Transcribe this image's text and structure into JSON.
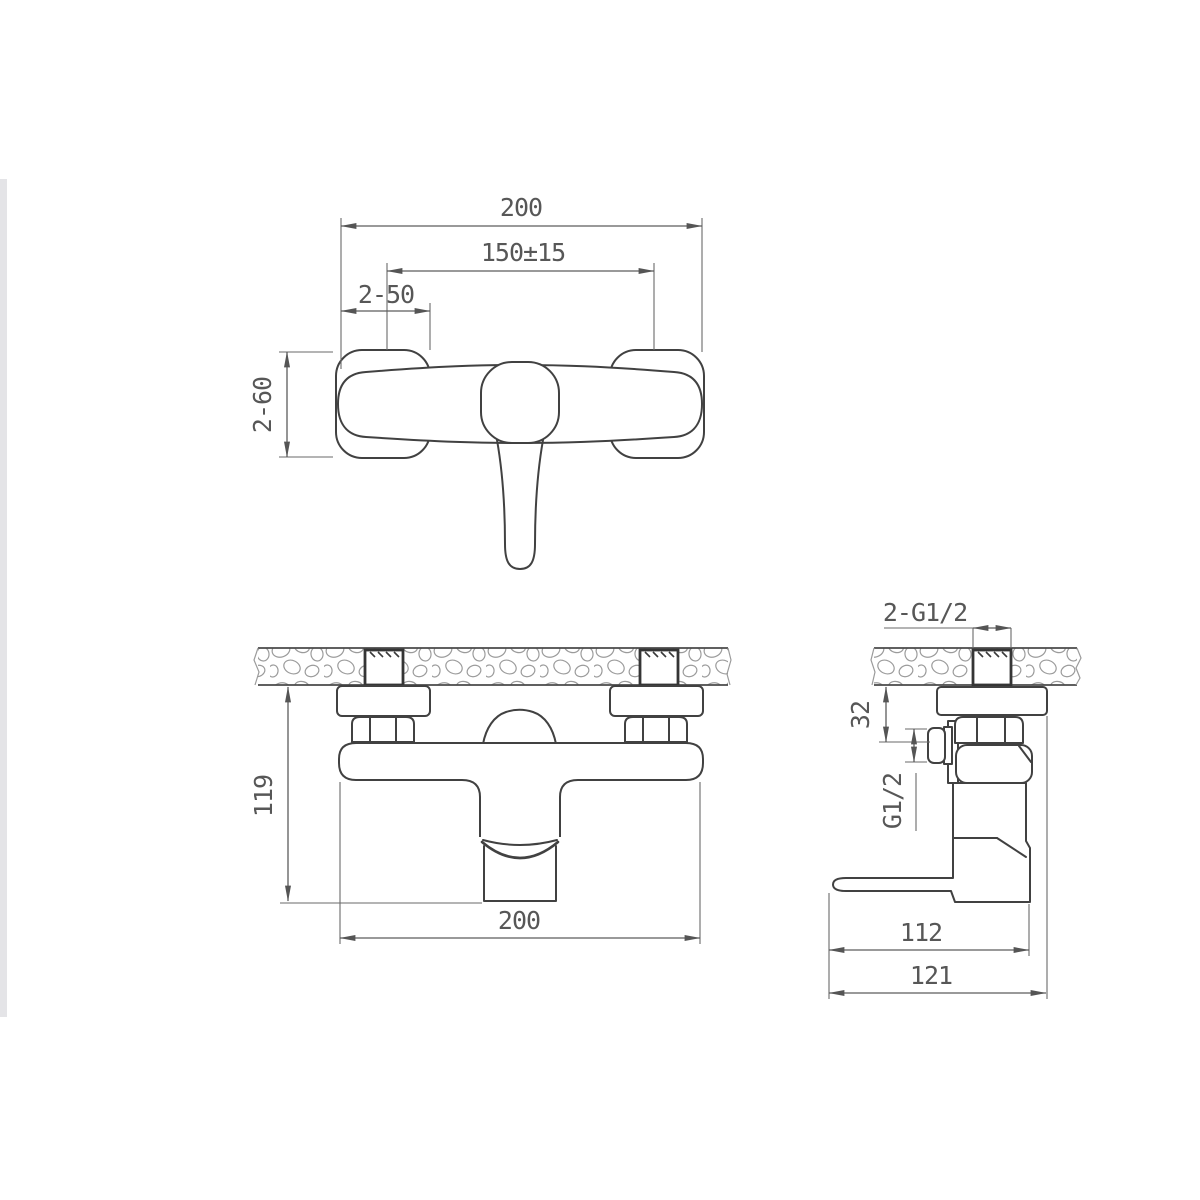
{
  "document": {
    "type": "technical-drawing",
    "subject": "wall-mounted shower mixer faucet, three orthographic views",
    "colors": {
      "background": "#ffffff",
      "object_line": "#414141",
      "dimension_line": "#5c5c5c",
      "dimension_text": "#575757",
      "wall_hatch": "#9b9b9b",
      "photo_edge_strip": "#e4e4e7"
    }
  },
  "dims": {
    "front": {
      "width": "200",
      "spacing": "150±15",
      "flange_w": "2-50",
      "flange_h": "2-60"
    },
    "installed": {
      "height": "119",
      "width": "200"
    },
    "side": {
      "wall_thread": "2-G1/2",
      "offset": "32",
      "outlet_thread": "G1/2",
      "depth_body": "112",
      "depth_total": "121"
    }
  }
}
